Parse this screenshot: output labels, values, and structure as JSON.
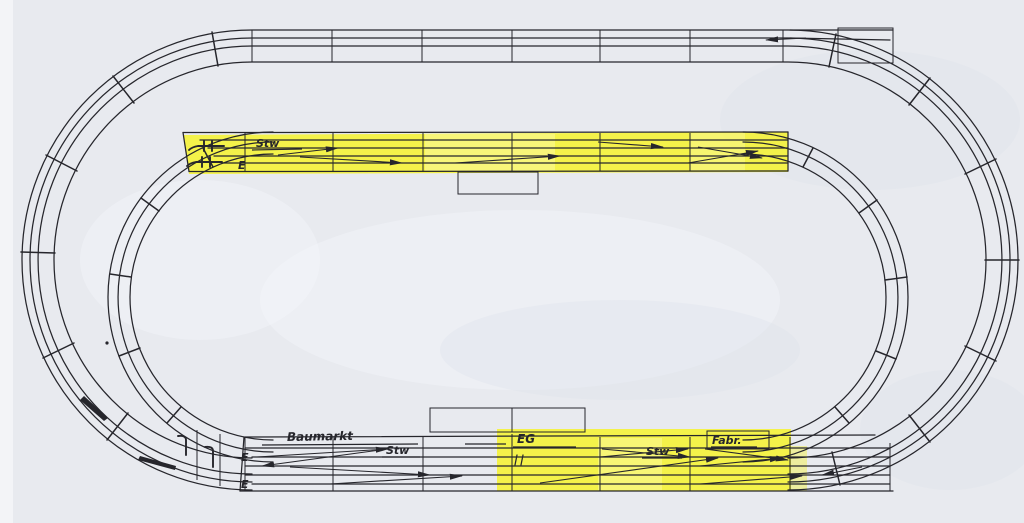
{
  "diagram": {
    "kind": "hand-drawn model railway track plan (scanned)",
    "colors": {
      "paper": "#e8eaef",
      "ink": "#26262c",
      "highlight": "#f4f23c",
      "highlight_light": "#fbf9a0"
    },
    "top_station": {
      "signal_box": "Stw",
      "entry_track": "E"
    },
    "bottom_station": {
      "hall": "Baumarkt",
      "signal_box_west": "Stw",
      "entry_track_upper": "E",
      "entry_track_lower": "E",
      "station_building": "EG",
      "signal_box_east": "Stw",
      "factory": "Fabr."
    }
  }
}
